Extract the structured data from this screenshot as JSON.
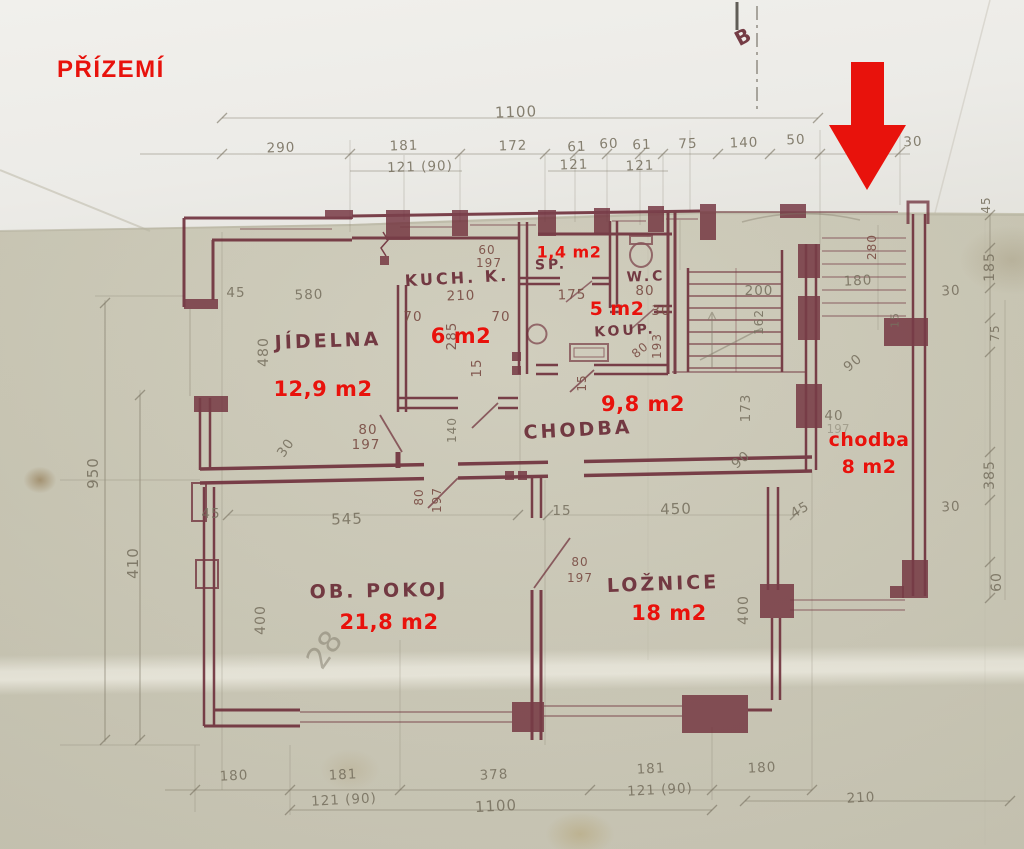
{
  "title": "PŘÍZEMÍ",
  "section_mark": {
    "text": "B",
    "x": 744,
    "y": 36,
    "rot": -28
  },
  "colors": {
    "red": "#e8120c",
    "wall": "#6e2e3a",
    "pencil": "#77705f",
    "ink": "#7b4f46",
    "maroon": "#6b2d38",
    "paper": "#c9c6b3"
  },
  "rooms": [
    {
      "name": "JÍDELNA",
      "area": "12,9 m2",
      "name_pos": {
        "x": 328,
        "y": 341,
        "r": -2,
        "s": 19
      },
      "area_pos": {
        "x": 323,
        "y": 389,
        "s": 21
      },
      "name_color": "maroon"
    },
    {
      "name": "KUCH. K.",
      "area": "6 m2",
      "name_pos": {
        "x": 457,
        "y": 278,
        "r": -3,
        "s": 16
      },
      "area_pos": {
        "x": 461,
        "y": 336,
        "s": 21
      },
      "name_color": "maroon"
    },
    {
      "name": "SP.",
      "area": "1,4 m2",
      "name_pos": {
        "x": 551,
        "y": 265,
        "r": -2,
        "s": 14
      },
      "area_pos": {
        "x": 569,
        "y": 252,
        "s": 16
      },
      "name_color": "maroon"
    },
    {
      "name": "W.C",
      "area": null,
      "name_pos": {
        "x": 646,
        "y": 277,
        "r": -2,
        "s": 14
      },
      "area_pos": null,
      "name_color": "maroon"
    },
    {
      "name": "KOUP.",
      "area": "5 m2",
      "name_pos": {
        "x": 625,
        "y": 331,
        "r": -3,
        "s": 14
      },
      "area_pos": {
        "x": 617,
        "y": 309,
        "s": 19
      },
      "name_color": "maroon"
    },
    {
      "name": "CHODBA",
      "area": "9,8 m2",
      "name_pos": {
        "x": 578,
        "y": 430,
        "r": -3,
        "s": 19
      },
      "area_pos": {
        "x": 643,
        "y": 404,
        "s": 21
      },
      "name_color": "maroon"
    },
    {
      "name": "chodba",
      "area": "8 m2",
      "name_pos": {
        "x": 869,
        "y": 440,
        "r": 0,
        "s": 19
      },
      "area_pos": {
        "x": 869,
        "y": 467,
        "s": 19
      },
      "name_color": "red"
    },
    {
      "name": "OB. POKOJ",
      "area": "21,8 m2",
      "name_pos": {
        "x": 379,
        "y": 591,
        "r": -1,
        "s": 19
      },
      "area_pos": {
        "x": 389,
        "y": 622,
        "s": 21
      },
      "name_color": "maroon"
    },
    {
      "name": "LOŽNICE",
      "area": "18 m2",
      "name_pos": {
        "x": 663,
        "y": 584,
        "r": -2,
        "s": 19
      },
      "area_pos": {
        "x": 669,
        "y": 613,
        "s": 21
      },
      "name_color": "maroon"
    }
  ],
  "dimensions": [
    {
      "t": "1100",
      "x": 516,
      "y": 112,
      "r": -2,
      "c": "p",
      "s": 15
    },
    {
      "t": "290",
      "x": 281,
      "y": 148,
      "r": -2,
      "c": "p"
    },
    {
      "t": "181",
      "x": 404,
      "y": 146,
      "r": -2,
      "c": "p"
    },
    {
      "t": "121 (90)",
      "x": 420,
      "y": 167,
      "r": -2,
      "c": "p"
    },
    {
      "t": "172",
      "x": 513,
      "y": 146,
      "r": -2,
      "c": "p"
    },
    {
      "t": "61",
      "x": 577,
      "y": 147,
      "r": -2,
      "c": "p"
    },
    {
      "t": "60",
      "x": 609,
      "y": 144,
      "r": -2,
      "c": "p"
    },
    {
      "t": "61",
      "x": 642,
      "y": 145,
      "r": -2,
      "c": "p"
    },
    {
      "t": "121",
      "x": 574,
      "y": 165,
      "r": -2,
      "c": "p"
    },
    {
      "t": "121",
      "x": 640,
      "y": 166,
      "r": -2,
      "c": "p"
    },
    {
      "t": "75",
      "x": 688,
      "y": 144,
      "r": -2,
      "c": "p"
    },
    {
      "t": "140",
      "x": 744,
      "y": 143,
      "r": -2,
      "c": "p"
    },
    {
      "t": "50",
      "x": 796,
      "y": 140,
      "r": -2,
      "c": "p"
    },
    {
      "t": "30",
      "x": 913,
      "y": 142,
      "r": -2,
      "c": "p"
    },
    {
      "t": "950",
      "x": 93,
      "y": 473,
      "r": -90,
      "c": "p",
      "s": 15
    },
    {
      "t": "410",
      "x": 133,
      "y": 563,
      "r": -90,
      "c": "p",
      "s": 15
    },
    {
      "t": "480",
      "x": 264,
      "y": 352,
      "r": -90,
      "c": "p",
      "s": 14
    },
    {
      "t": "45",
      "x": 236,
      "y": 293,
      "r": 0,
      "c": "p"
    },
    {
      "t": "580",
      "x": 309,
      "y": 295,
      "r": -2,
      "c": "p"
    },
    {
      "t": "30",
      "x": 286,
      "y": 448,
      "r": -55,
      "c": "p"
    },
    {
      "t": "80",
      "x": 368,
      "y": 430,
      "r": 0,
      "c": "i"
    },
    {
      "t": "197",
      "x": 366,
      "y": 445,
      "r": 0,
      "c": "i"
    },
    {
      "t": "60",
      "x": 487,
      "y": 250,
      "r": 0,
      "c": "i",
      "s": 12
    },
    {
      "t": "197",
      "x": 489,
      "y": 263,
      "r": 0,
      "c": "i",
      "s": 12
    },
    {
      "t": "210",
      "x": 461,
      "y": 296,
      "r": -2,
      "c": "i"
    },
    {
      "t": "70",
      "x": 413,
      "y": 317,
      "r": 0,
      "c": "i"
    },
    {
      "t": "285",
      "x": 452,
      "y": 336,
      "r": -90,
      "c": "i"
    },
    {
      "t": "70",
      "x": 501,
      "y": 317,
      "r": 0,
      "c": "i"
    },
    {
      "t": "15",
      "x": 477,
      "y": 368,
      "r": -90,
      "c": "i"
    },
    {
      "t": "175",
      "x": 572,
      "y": 295,
      "r": -2,
      "c": "i"
    },
    {
      "t": "80",
      "x": 645,
      "y": 291,
      "r": 0,
      "c": "i"
    },
    {
      "t": "30",
      "x": 661,
      "y": 311,
      "r": 0,
      "c": "i"
    },
    {
      "t": "193",
      "x": 657,
      "y": 346,
      "r": -90,
      "c": "i",
      "s": 12
    },
    {
      "t": "80",
      "x": 640,
      "y": 350,
      "r": -40,
      "c": "i",
      "s": 12
    },
    {
      "t": "15",
      "x": 582,
      "y": 383,
      "r": -90,
      "c": "i",
      "s": 12
    },
    {
      "t": "200",
      "x": 759,
      "y": 291,
      "r": 0,
      "c": "p"
    },
    {
      "t": "162",
      "x": 759,
      "y": 322,
      "r": -90,
      "c": "p",
      "s": 12
    },
    {
      "t": "173",
      "x": 746,
      "y": 408,
      "r": -90,
      "c": "p"
    },
    {
      "t": "180",
      "x": 858,
      "y": 281,
      "r": -3,
      "c": "p"
    },
    {
      "t": "280",
      "x": 872,
      "y": 247,
      "r": -90,
      "c": "i",
      "s": 12
    },
    {
      "t": "90",
      "x": 853,
      "y": 363,
      "r": -40,
      "c": "p"
    },
    {
      "t": "40",
      "x": 834,
      "y": 416,
      "r": 0,
      "c": "p"
    },
    {
      "t": "197",
      "x": 838,
      "y": 429,
      "r": 0,
      "c": "f",
      "s": 12
    },
    {
      "t": "90",
      "x": 741,
      "y": 460,
      "r": -40,
      "c": "p"
    },
    {
      "t": "45",
      "x": 986,
      "y": 205,
      "r": -90,
      "c": "p",
      "s": 12
    },
    {
      "t": "185",
      "x": 990,
      "y": 267,
      "r": -90,
      "c": "p",
      "s": 14
    },
    {
      "t": "30",
      "x": 951,
      "y": 291,
      "r": -3,
      "c": "p"
    },
    {
      "t": "75",
      "x": 995,
      "y": 333,
      "r": -90,
      "c": "p",
      "s": 12
    },
    {
      "t": "15",
      "x": 895,
      "y": 320,
      "r": -90,
      "c": "p",
      "s": 11
    },
    {
      "t": "385",
      "x": 990,
      "y": 475,
      "r": -90,
      "c": "p",
      "s": 14
    },
    {
      "t": "30",
      "x": 951,
      "y": 507,
      "r": -3,
      "c": "p"
    },
    {
      "t": "60",
      "x": 997,
      "y": 582,
      "r": -90,
      "c": "p",
      "s": 14
    },
    {
      "t": "140",
      "x": 452,
      "y": 430,
      "r": -90,
      "c": "p",
      "s": 12
    },
    {
      "t": "80",
      "x": 419,
      "y": 497,
      "r": -90,
      "c": "i",
      "s": 12
    },
    {
      "t": "197",
      "x": 437,
      "y": 500,
      "r": -90,
      "c": "i",
      "s": 12
    },
    {
      "t": "45",
      "x": 211,
      "y": 514,
      "r": 0,
      "c": "p"
    },
    {
      "t": "545",
      "x": 347,
      "y": 519,
      "r": -2,
      "c": "p",
      "s": 15
    },
    {
      "t": "15",
      "x": 562,
      "y": 511,
      "r": 0,
      "c": "p"
    },
    {
      "t": "450",
      "x": 676,
      "y": 509,
      "r": -2,
      "c": "p",
      "s": 15
    },
    {
      "t": "45",
      "x": 800,
      "y": 510,
      "r": -30,
      "c": "p"
    },
    {
      "t": "400",
      "x": 261,
      "y": 620,
      "r": -90,
      "c": "p",
      "s": 14
    },
    {
      "t": "28",
      "x": 325,
      "y": 650,
      "r": -55,
      "c": "f",
      "s": 30
    },
    {
      "t": "80",
      "x": 580,
      "y": 562,
      "r": 0,
      "c": "i",
      "s": 12
    },
    {
      "t": "197",
      "x": 580,
      "y": 578,
      "r": 0,
      "c": "i",
      "s": 12
    },
    {
      "t": "400",
      "x": 744,
      "y": 610,
      "r": -90,
      "c": "p",
      "s": 14
    },
    {
      "t": "180",
      "x": 234,
      "y": 776,
      "r": -3,
      "c": "p"
    },
    {
      "t": "181",
      "x": 343,
      "y": 775,
      "r": -3,
      "c": "p"
    },
    {
      "t": "121 (90)",
      "x": 344,
      "y": 800,
      "r": -3,
      "c": "p"
    },
    {
      "t": "378",
      "x": 494,
      "y": 775,
      "r": -3,
      "c": "p"
    },
    {
      "t": "1100",
      "x": 496,
      "y": 806,
      "r": -3,
      "c": "p",
      "s": 15
    },
    {
      "t": "181",
      "x": 651,
      "y": 769,
      "r": -3,
      "c": "p"
    },
    {
      "t": "121 (90)",
      "x": 660,
      "y": 790,
      "r": -3,
      "c": "p"
    },
    {
      "t": "180",
      "x": 762,
      "y": 768,
      "r": -3,
      "c": "p"
    },
    {
      "t": "210",
      "x": 861,
      "y": 798,
      "r": -3,
      "c": "p"
    }
  ]
}
